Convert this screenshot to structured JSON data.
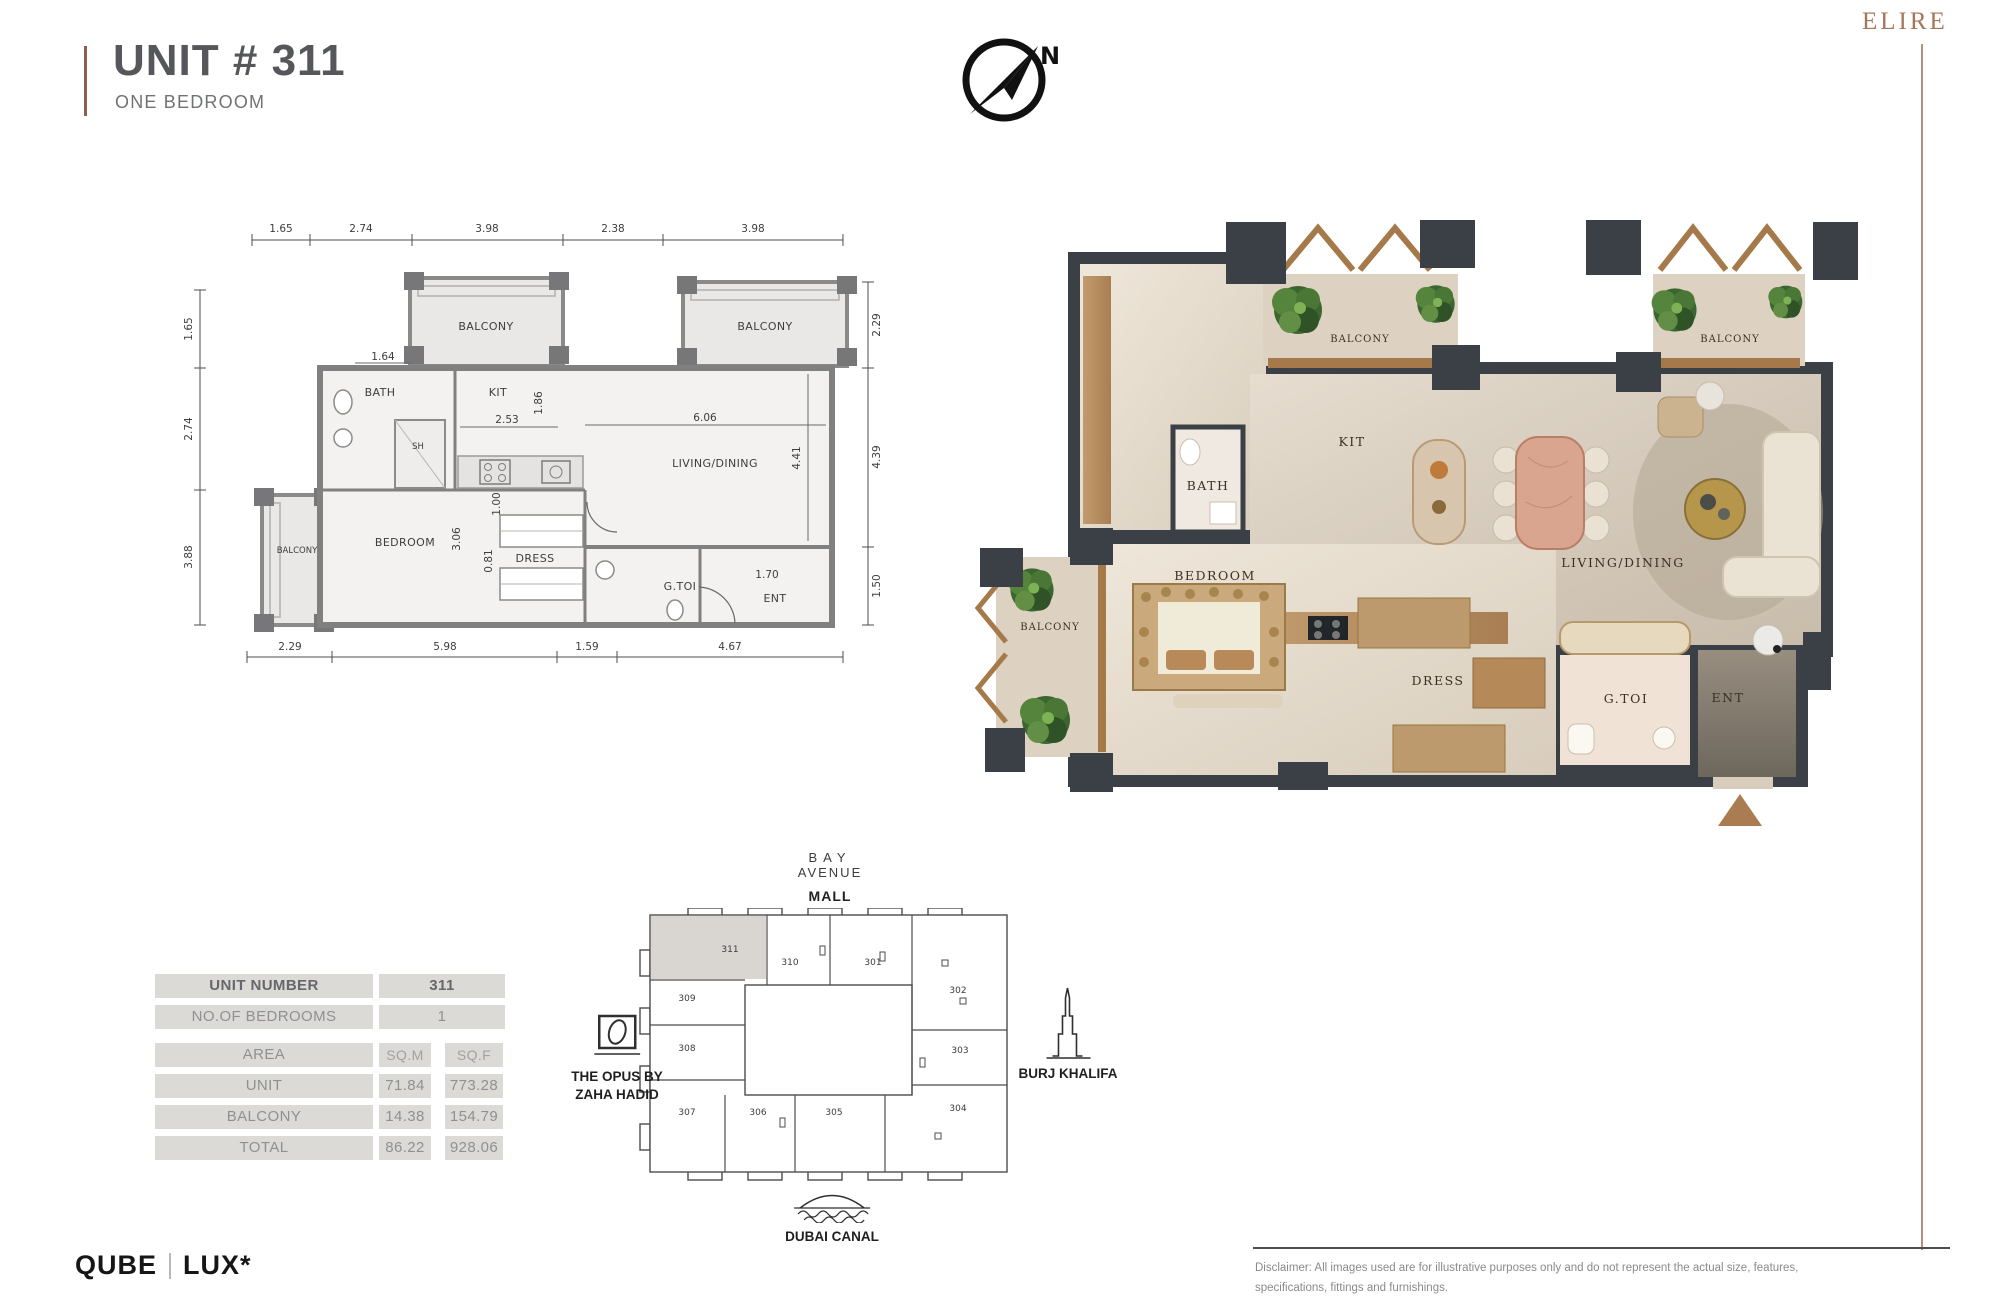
{
  "header": {
    "title": "UNIT # 311",
    "subtitle": "ONE BEDROOM",
    "brand": "ELIRE",
    "compass_n": "N"
  },
  "colors": {
    "accent_copper": "#8d5f4c",
    "brand_copper": "#a7755b",
    "render_wall_charcoal": "#3b4046",
    "plan_wall_gray": "#808080",
    "table_cell_gray": "#dbdad6",
    "key_plan_highlight": "#d9d6d1",
    "entrance_arrow_brown": "#a97c52"
  },
  "floor_plan": {
    "labels": {
      "balcony_top_left": "BALCONY",
      "balcony_top_right": "BALCONY",
      "balcony_left": "BALCONY",
      "bath": "BATH",
      "shower": "SH",
      "kitchen": "KIT",
      "living": "LIVING/DINING",
      "bedroom": "BEDROOM",
      "dress": "DRESS",
      "guest_toilet": "G.TOI",
      "entrance": "ENT"
    },
    "dims_top": [
      "1.65",
      "2.74",
      "3.98",
      "2.38",
      "3.98"
    ],
    "dims_left": [
      "1.65",
      "2.74",
      "3.88"
    ],
    "dims_right": [
      "2.29",
      "4.39",
      "1.50"
    ],
    "dims_bottom": [
      "2.29",
      "5.98",
      "1.59",
      "4.67"
    ],
    "dims_inner": {
      "bath_w": "1.64",
      "kit_w": "2.53",
      "kit_h": "1.86",
      "living_w": "6.06",
      "living_h": "4.41",
      "pass": "1.00",
      "bedroom_h": "3.06",
      "dress_h": "0.81",
      "ent_w": "1.70"
    }
  },
  "render_plan": {
    "labels": {
      "balcony_kitchen": "BALCONY",
      "balcony_living": "BALCONY",
      "balcony_bedroom": "BALCONY",
      "kitchen": "KIT",
      "bath": "BATH",
      "bedroom": "BEDROOM",
      "dress": "DRESS",
      "living": "LIVING/DINING",
      "guest_toilet": "G.TOI",
      "entrance": "ENT"
    }
  },
  "unit_table": {
    "rows": [
      {
        "label": "UNIT NUMBER",
        "value": "311"
      },
      {
        "label": "NO.OF BEDROOMS",
        "value": "1"
      },
      {
        "label": "AREA",
        "col1": "SQ.M",
        "col2": "SQ.F"
      },
      {
        "label": "UNIT",
        "col1": "71.84",
        "col2": "773.28"
      },
      {
        "label": "BALCONY",
        "col1": "14.38",
        "col2": "154.79"
      },
      {
        "label": "TOTAL",
        "col1": "86.22",
        "col2": "928.06"
      }
    ]
  },
  "key_plan": {
    "mall_line1": "BAY",
    "mall_line2": "AVENUE",
    "mall_line3": "MALL",
    "opus_line1": "THE OPUS BY",
    "opus_line2": "ZAHA HADID",
    "burj": "BURJ KHALIFA",
    "canal": "DUBAI CANAL",
    "highlighted_unit": "311",
    "units": {
      "u311": "311",
      "u310": "310",
      "u301": "301",
      "u302": "302",
      "u309": "309",
      "u308": "308",
      "u307": "307",
      "u306": "306",
      "u305": "305",
      "u304": "304",
      "u303": "303"
    }
  },
  "footer": {
    "logo_primary": "QUBE",
    "logo_secondary": "LUX*",
    "disclaimer_l1": "Disclaimer: All images used are for illustrative purposes only and do not represent the actual size, features,",
    "disclaimer_l2": "specifications, fittings and furnishings."
  }
}
